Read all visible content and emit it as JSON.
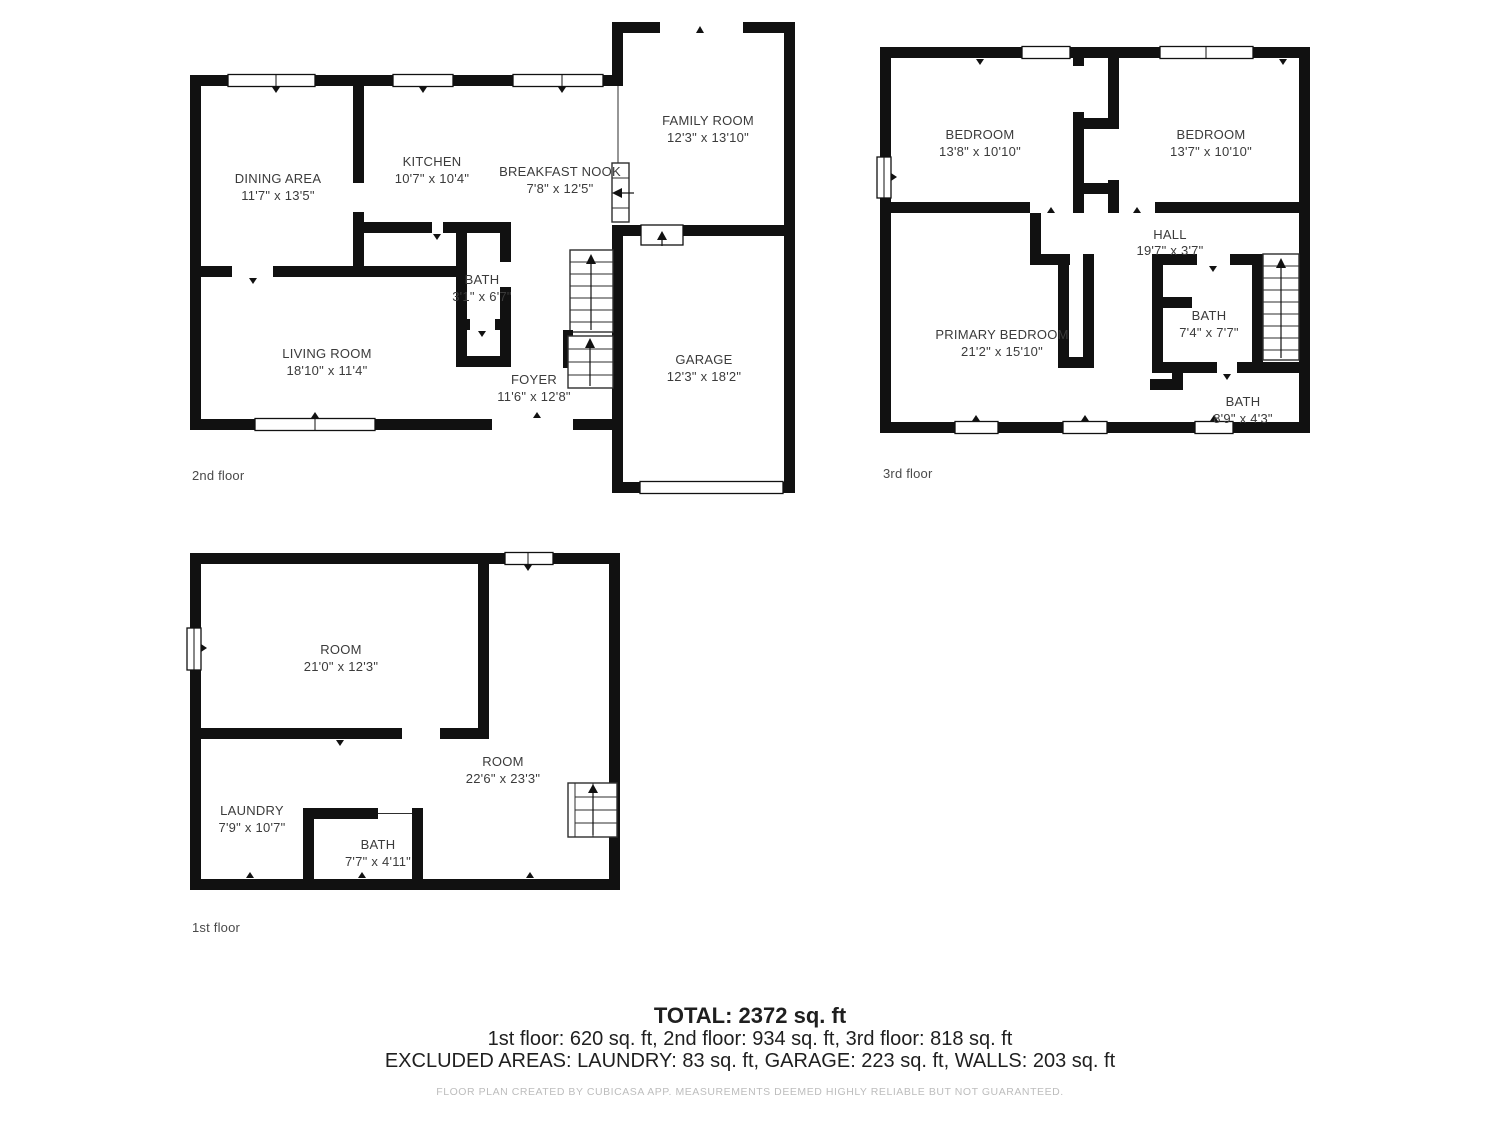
{
  "floors": {
    "f2": {
      "label": "2nd floor",
      "rooms": [
        {
          "name": "DINING AREA",
          "dims": "11'7\" x 13'5\""
        },
        {
          "name": "KITCHEN",
          "dims": "10'7\" x 10'4\""
        },
        {
          "name": "BREAKFAST NOOK",
          "dims": "7'8\" x 12'5\""
        },
        {
          "name": "FAMILY ROOM",
          "dims": "12'3\" x 13'10\""
        },
        {
          "name": "BATH",
          "dims": "3'1\" x 6'7\""
        },
        {
          "name": "LIVING ROOM",
          "dims": "18'10\" x 11'4\""
        },
        {
          "name": "FOYER",
          "dims": "11'6\" x 12'8\""
        },
        {
          "name": "GARAGE",
          "dims": "12'3\" x 18'2\""
        }
      ]
    },
    "f3": {
      "label": "3rd floor",
      "rooms": [
        {
          "name": "BEDROOM",
          "dims": "13'8\" x 10'10\""
        },
        {
          "name": "BEDROOM",
          "dims": "13'7\" x 10'10\""
        },
        {
          "name": "HALL",
          "dims": "19'7\" x 3'7\""
        },
        {
          "name": "PRIMARY BEDROOM",
          "dims": "21'2\" x 15'10\""
        },
        {
          "name": "BATH",
          "dims": "7'4\" x 7'7\""
        },
        {
          "name": "BATH",
          "dims": "8'9\" x 4'3\""
        }
      ]
    },
    "f1": {
      "label": "1st floor",
      "rooms": [
        {
          "name": "ROOM",
          "dims": "21'0\" x 12'3\""
        },
        {
          "name": "ROOM",
          "dims": "22'6\" x 23'3\""
        },
        {
          "name": "LAUNDRY",
          "dims": "7'9\" x 10'7\""
        },
        {
          "name": "BATH",
          "dims": "7'7\" x 4'11\""
        }
      ]
    }
  },
  "summary": {
    "total": "TOTAL: 2372 sq. ft",
    "floors_line": "1st floor: 620 sq. ft, 2nd floor: 934 sq. ft, 3rd floor: 818 sq. ft",
    "excluded_line": "EXCLUDED AREAS: LAUNDRY: 83 sq. ft, GARAGE: 223 sq. ft, WALLS: 203 sq. ft"
  },
  "footer_note": "FLOOR PLAN CREATED BY CUBICASA APP. MEASUREMENTS DEEMED HIGHLY RELIABLE BUT NOT GUARANTEED.",
  "colors": {
    "wall": "#111111",
    "label": "#3b3b3b",
    "floorlabel": "#4a4a4a",
    "summary": "#1f1f1f",
    "footer": "#bdbdbd"
  }
}
